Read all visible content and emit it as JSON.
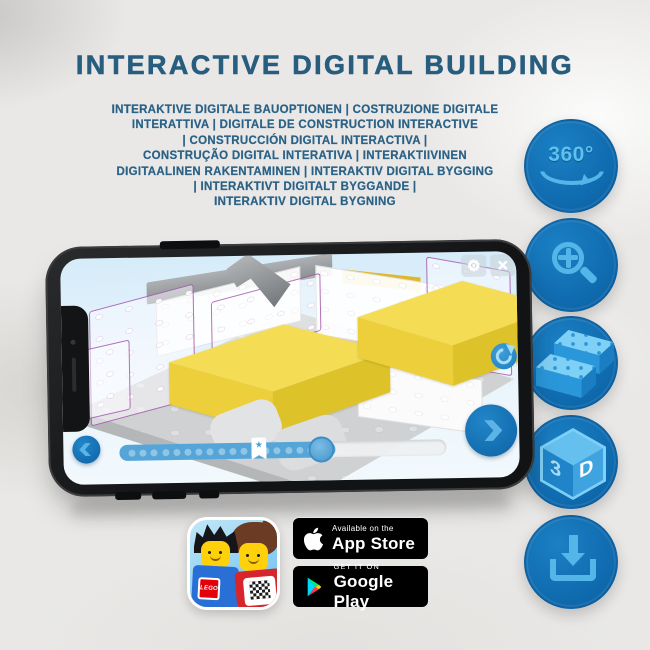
{
  "title": "INTERACTIVE DIGITAL BUILDING",
  "subtitle_lines": [
    "INTERAKTIVE DIGITALE BAUOPTIONEN | COSTRUZIONE DIGITALE",
    "INTERATTIVA | DIGITALE DE CONSTRUCTION INTERACTIVE",
    "| CONSTRUCCIÓN DIGITAL INTERACTIVA |",
    "CONSTRUÇÃO DIGITAL INTERATIVA | INTERAKTIIVINEN",
    "DIGITAALINEN RAKENTAMINEN | INTERAKTIV DIGITAL BYGGING",
    "| INTERAKTIVT DIGITALT BYGGANDE |",
    "INTERAKTIV DIGITAL BYGNING"
  ],
  "side_icons": {
    "rotate360_label": "360°",
    "cube_left": "3",
    "cube_right": "D"
  },
  "phone_ui": {
    "gear_glyph": "⚙",
    "close_glyph": "×",
    "star_glyph": "★"
  },
  "store": {
    "app_store_top": "Available on the",
    "app_store_name": "App Store",
    "google_play_top": "GET IT ON",
    "google_play_name": "Google Play",
    "lego_logo": "LEGO"
  },
  "colors": {
    "headline_blue": "#275d7e",
    "circle_blue": "#0e67ab",
    "glyph_blue": "#54b6e8",
    "lego_yellow": "#f4dd55",
    "slider_blue": "#55a5d8",
    "ghost_outline_purple": "#9842a2"
  }
}
